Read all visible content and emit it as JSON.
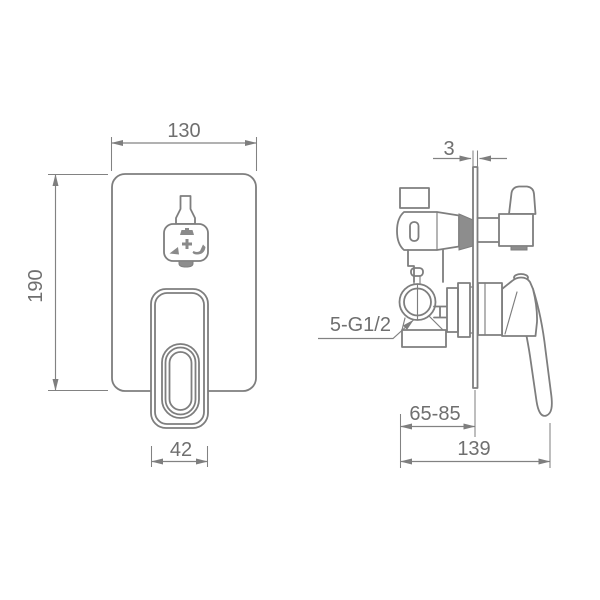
{
  "drawing": {
    "kind": "technical-dimension-drawing",
    "subject": "concealed shower mixer valve, front and side views",
    "colors": {
      "line": "#7e7e7e",
      "text": "#6f6f6f",
      "dark_fill": "#8d8d8d",
      "background": "#ffffff"
    },
    "front_view": {
      "width": "130",
      "height": "190",
      "handle_width": "42"
    },
    "side_view": {
      "plate_thickness": "3",
      "connection_thread": "5-G1/2",
      "install_depth_range": "65-85",
      "total_depth": "139"
    }
  }
}
